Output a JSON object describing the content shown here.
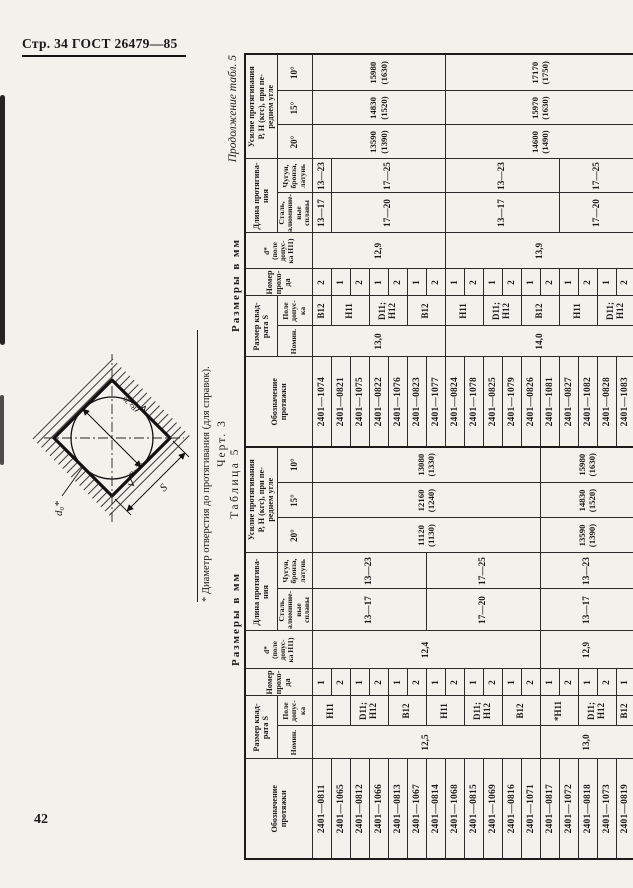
{
  "page": {
    "header": "Стр. 34 ГОСТ 26479—85",
    "page_number": "42"
  },
  "figure": {
    "caption": "Черт. 3",
    "diameter_label": "d₀*",
    "size_label": "S",
    "roughness_label": "Rz 20",
    "footnote": "* Диаметр отверстия до протягивания (для справок)."
  },
  "table_headers": {
    "designation": "Обозначение\nпротяжки",
    "size": "Размер квад-\nрата S",
    "nominal": "Номин.",
    "tolerance": "Поле\nдопус-\nка",
    "pass": "Номер\nпрохо-\nда",
    "d": "d*\n(поле\nдопус-\nка Н11)",
    "length": "Длина протягива-\nния",
    "steel": "Сталь,\nалюминие-\nвые сплавы",
    "iron": "Чугун,\nбронза,\nлатунь",
    "force": "Усилие протягивания\nР, Н (кгс), при пе-\nреднем угле",
    "deg20": "20°",
    "deg15": "15°",
    "deg10": "10°"
  },
  "table5": {
    "caption_size": "Размеры в мм",
    "caption_table": "Таблица 5",
    "rows": [
      {
        "designation": "2401—0811",
        "pass": "1"
      },
      {
        "designation": "2401—1065",
        "pass": "2"
      },
      {
        "designation": "2401—0812",
        "pass": "1"
      },
      {
        "designation": "2401—1066",
        "pass": "2"
      },
      {
        "designation": "2401—0813",
        "pass": "1"
      },
      {
        "designation": "2401—1067",
        "pass": "2"
      },
      {
        "designation": "2401—0814",
        "pass": "1"
      },
      {
        "designation": "2401—1068",
        "pass": "2"
      },
      {
        "designation": "2401—0815",
        "pass": "1"
      },
      {
        "designation": "2401—1069",
        "pass": "2"
      },
      {
        "designation": "2401—0816",
        "pass": "1"
      },
      {
        "designation": "2401—1071",
        "pass": "2"
      },
      {
        "designation": "2401—0817",
        "pass": "1"
      },
      {
        "designation": "2401—1072",
        "pass": "2"
      },
      {
        "designation": "2401—0818",
        "pass": "1"
      },
      {
        "designation": "2401—1073",
        "pass": "2"
      },
      {
        "designation": "2401—0819",
        "pass": "1"
      }
    ],
    "spans": {
      "nominal": [
        {
          "text": "12,5",
          "rows": 12
        },
        {
          "text": "13,0",
          "rows": 5
        }
      ],
      "tolerance": [
        {
          "text": "Н11",
          "rows": 2
        },
        {
          "text": "D11;\nН12",
          "rows": 2
        },
        {
          "text": "В12",
          "rows": 2
        },
        {
          "text": "Н11",
          "rows": 2
        },
        {
          "text": "D11;\nН12",
          "rows": 2
        },
        {
          "text": "В12",
          "rows": 2
        },
        {
          "text": "*Н11",
          "rows": 2
        },
        {
          "text": "D11;\nН12",
          "rows": 2
        },
        {
          "text": "В12",
          "rows": 1
        }
      ],
      "d": [
        {
          "text": "12,4",
          "rows": 12
        },
        {
          "text": "12,9",
          "rows": 5
        }
      ],
      "steel": [
        {
          "text": "13—17",
          "rows": 6
        },
        {
          "text": "17—20",
          "rows": 6
        },
        {
          "text": "13—17",
          "rows": 5
        }
      ],
      "iron": [
        {
          "text": "13—23",
          "rows": 6
        },
        {
          "text": "17—25",
          "rows": 6
        },
        {
          "text": "13—23",
          "rows": 5
        }
      ],
      "f20": [
        {
          "text": "11120\n(1130)",
          "rows": 12
        },
        {
          "text": "13590\n(1390)",
          "rows": 5
        }
      ],
      "f15": [
        {
          "text": "12160\n(1240)",
          "rows": 12
        },
        {
          "text": "14830\n(1520)",
          "rows": 5
        }
      ],
      "f10": [
        {
          "text": "13080\n(1330)",
          "rows": 12
        },
        {
          "text": "15980\n(1630)",
          "rows": 5
        }
      ]
    }
  },
  "table5_cont": {
    "caption_size": "Размеры в мм",
    "caption_table": "Продолжение табл. 5",
    "rows": [
      {
        "designation": "2401—1074",
        "pass": "2"
      },
      {
        "designation": "2401—0821",
        "pass": "1"
      },
      {
        "designation": "2401—1075",
        "pass": "2"
      },
      {
        "designation": "2401—0822",
        "pass": "1"
      },
      {
        "designation": "2401—1076",
        "pass": "2"
      },
      {
        "designation": "2401—0823",
        "pass": "1"
      },
      {
        "designation": "2401—1077",
        "pass": "2"
      },
      {
        "designation": "2401—0824",
        "pass": "1"
      },
      {
        "designation": "2401—1078",
        "pass": "2"
      },
      {
        "designation": "2401—0825",
        "pass": "1"
      },
      {
        "designation": "2401—1079",
        "pass": "2"
      },
      {
        "designation": "2401—0826",
        "pass": "1"
      },
      {
        "designation": "2401—1081",
        "pass": "2"
      },
      {
        "designation": "2401—0827",
        "pass": "1"
      },
      {
        "designation": "2401—1082",
        "pass": "2"
      },
      {
        "designation": "2401—0828",
        "pass": "1"
      },
      {
        "designation": "2401—1083",
        "pass": "2"
      }
    ],
    "spans": {
      "nominal": [
        {
          "text": "13,0",
          "rows": 7
        },
        {
          "text": "14,0",
          "rows": 10
        }
      ],
      "tolerance": [
        {
          "text": "В12",
          "rows": 1
        },
        {
          "text": "Н11",
          "rows": 2
        },
        {
          "text": "D11;\nН12",
          "rows": 2
        },
        {
          "text": "В12",
          "rows": 2
        },
        {
          "text": "Н11",
          "rows": 2
        },
        {
          "text": "D11;\nН12",
          "rows": 2
        },
        {
          "text": "В12",
          "rows": 2
        },
        {
          "text": "Н11",
          "rows": 2
        },
        {
          "text": "D11;\nН12",
          "rows": 2
        }
      ],
      "d": [
        {
          "text": "12,9",
          "rows": 7
        },
        {
          "text": "13,9",
          "rows": 10
        }
      ],
      "steel": [
        {
          "text": "13—17",
          "rows": 1
        },
        {
          "text": "17—20",
          "rows": 6
        },
        {
          "text": "13—17",
          "rows": 6
        },
        {
          "text": "17—20",
          "rows": 4
        }
      ],
      "iron": [
        {
          "text": "13—23",
          "rows": 1
        },
        {
          "text": "17—25",
          "rows": 6
        },
        {
          "text": "13—23",
          "rows": 6
        },
        {
          "text": "17—25",
          "rows": 4
        }
      ],
      "f20": [
        {
          "text": "13590\n(1390)",
          "rows": 7
        },
        {
          "text": "14600\n(1490)",
          "rows": 10
        }
      ],
      "f15": [
        {
          "text": "14830\n(1520)",
          "rows": 7
        },
        {
          "text": "15970\n(1630)",
          "rows": 10
        }
      ],
      "f10": [
        {
          "text": "15980\n(1630)",
          "rows": 7
        },
        {
          "text": "17170\n(1750)",
          "rows": 10
        }
      ]
    }
  }
}
